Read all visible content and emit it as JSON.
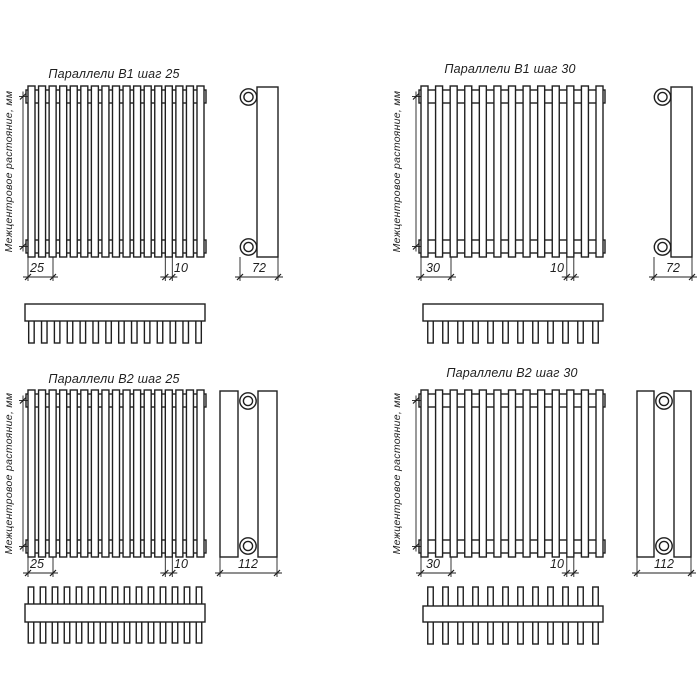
{
  "canvas": {
    "width": 700,
    "height": 700,
    "bg": "#ffffff",
    "line_color": "#1f1f1f",
    "fill_color": "#ffffff",
    "object_stroke": 1.4,
    "dim_stroke": 0.9
  },
  "shared": {
    "center_distance_label": "Межцентровое растояние, мм"
  },
  "drawings": [
    {
      "id": "parallels-b1-step-25",
      "title": "Параллели В1 шаг 25",
      "title_pos": [
        114,
        78
      ],
      "front": {
        "x": 28,
        "y": 86,
        "w": 176,
        "h": 171,
        "tubes": 17,
        "tube_w": 7,
        "band_inset": 4,
        "band_h": 13,
        "band_ext": 2
      },
      "vdim": {
        "x": 23,
        "label_pos": [
          12,
          171.5
        ]
      },
      "dims": [
        {
          "label": "25",
          "x1": 28,
          "x2": 53,
          "y": 277,
          "label_pos": [
            37,
            272
          ],
          "ext_from": 257
        },
        {
          "label": "10",
          "x1": 165.3,
          "x2": 172.3,
          "y": 277,
          "label_pos": [
            181,
            272
          ],
          "ext_from": 257
        }
      ],
      "side": {
        "rects": [
          [
            257,
            87,
            21,
            170
          ]
        ],
        "cx": 248.5,
        "cy": [
          97,
          247
        ],
        "r_out": 8.2,
        "r_in": 4.6,
        "dim": {
          "label": "72",
          "x1": 240,
          "x2": 278,
          "y": 277,
          "label_pos": [
            259,
            272
          ],
          "ext_from": 257
        }
      },
      "comb": {
        "x": 25,
        "y": 304,
        "w": 180,
        "bar_h": 17,
        "teeth": 14,
        "tooth_w": 5.5,
        "tooth_down": 22,
        "tooth_up": 0,
        "both": false
      }
    },
    {
      "id": "parallels-b1-step-30",
      "title": "Параллели В1 шаг 30",
      "title_pos": [
        510,
        73
      ],
      "front": {
        "x": 421,
        "y": 86,
        "w": 182,
        "h": 171,
        "tubes": 13,
        "tube_w": 7,
        "band_inset": 4,
        "band_h": 13,
        "band_ext": 2
      },
      "vdim": {
        "x": 416,
        "label_pos": [
          400,
          171.5
        ]
      },
      "dims": [
        {
          "label": "30",
          "x1": 421,
          "x2": 451,
          "y": 277,
          "label_pos": [
            433,
            272
          ],
          "ext_from": 257
        },
        {
          "label": "10",
          "x1": 566.8,
          "x2": 573.8,
          "y": 277,
          "label_pos": [
            557,
            272
          ],
          "ext_from": 257
        }
      ],
      "side": {
        "rects": [
          [
            671,
            87,
            21,
            170
          ]
        ],
        "cx": 662.5,
        "cy": [
          97,
          247
        ],
        "r_out": 8.2,
        "r_in": 4.6,
        "dim": {
          "label": "72",
          "x1": 654,
          "x2": 692,
          "y": 277,
          "label_pos": [
            673,
            272
          ],
          "ext_from": 257
        }
      },
      "comb": {
        "x": 423,
        "y": 304,
        "w": 180,
        "bar_h": 17,
        "teeth": 12,
        "tooth_w": 5.5,
        "tooth_down": 22,
        "tooth_up": 0,
        "both": false
      }
    },
    {
      "id": "parallels-b2-step-25",
      "title": "Параллели В2 шаг 25",
      "title_pos": [
        114,
        383
      ],
      "front": {
        "x": 28,
        "y": 390,
        "w": 176,
        "h": 167,
        "tubes": 17,
        "tube_w": 7,
        "band_inset": 4,
        "band_h": 13,
        "band_ext": 2
      },
      "vdim": {
        "x": 23,
        "label_pos": [
          12,
          473.5
        ]
      },
      "dims": [
        {
          "label": "25",
          "x1": 28,
          "x2": 53,
          "y": 573,
          "label_pos": [
            37,
            568
          ],
          "ext_from": 557
        },
        {
          "label": "10",
          "x1": 165.3,
          "x2": 172.3,
          "y": 573,
          "label_pos": [
            181,
            568
          ],
          "ext_from": 557
        }
      ],
      "side": {
        "rects": [
          [
            220,
            391,
            18,
            166
          ],
          [
            258,
            391,
            19,
            166
          ]
        ],
        "cx": 248,
        "cy": [
          401,
          546
        ],
        "r_out": 8.2,
        "r_in": 4.6,
        "dim": {
          "label": "112",
          "x1": 220,
          "x2": 277,
          "y": 573,
          "label_pos": [
            248,
            568
          ],
          "ext_from": 557
        }
      },
      "comb": {
        "x": 25,
        "y": 604,
        "w": 180,
        "bar_h": 18,
        "teeth": 15,
        "tooth_w": 5.5,
        "tooth_down": 21,
        "tooth_up": 17,
        "both": true
      }
    },
    {
      "id": "parallels-b2-step-30",
      "title": "Параллели В2 шаг 30",
      "title_pos": [
        512,
        377
      ],
      "front": {
        "x": 421,
        "y": 390,
        "w": 182,
        "h": 167,
        "tubes": 13,
        "tube_w": 7,
        "band_inset": 4,
        "band_h": 13,
        "band_ext": 2
      },
      "vdim": {
        "x": 416,
        "label_pos": [
          400,
          473.5
        ]
      },
      "dims": [
        {
          "label": "30",
          "x1": 421,
          "x2": 451,
          "y": 573,
          "label_pos": [
            433,
            568
          ],
          "ext_from": 557
        },
        {
          "label": "10",
          "x1": 566.8,
          "x2": 573.8,
          "y": 573,
          "label_pos": [
            557,
            568
          ],
          "ext_from": 557
        }
      ],
      "side": {
        "rects": [
          [
            637,
            391,
            17,
            166
          ],
          [
            674,
            391,
            17,
            166
          ]
        ],
        "cx": 664,
        "cy": [
          401,
          546
        ],
        "r_out": 8.2,
        "r_in": 4.6,
        "dim": {
          "label": "112",
          "x1": 637,
          "x2": 691,
          "y": 573,
          "label_pos": [
            664,
            568
          ],
          "ext_from": 557
        }
      },
      "comb": {
        "x": 423,
        "y": 606,
        "w": 180,
        "bar_h": 16,
        "teeth": 12,
        "tooth_w": 5.5,
        "tooth_down": 22,
        "tooth_up": 19,
        "both": true
      }
    }
  ]
}
